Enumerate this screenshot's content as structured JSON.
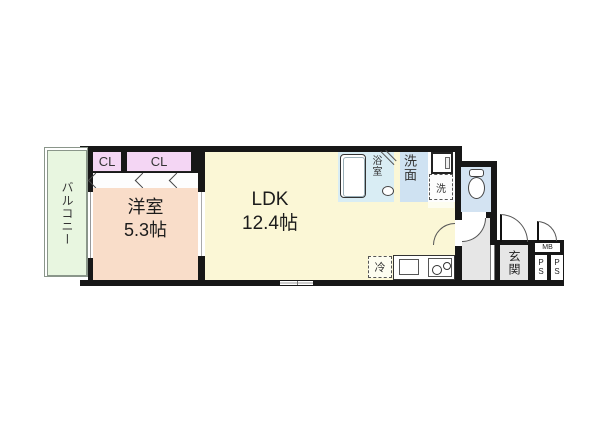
{
  "rooms": {
    "balcony": {
      "label": "バルコニー",
      "color": "#e8f6e0"
    },
    "closet_left": {
      "label": "CL",
      "color": "#f4d6f4"
    },
    "closet_right": {
      "label": "CL",
      "color": "#f4d6f4"
    },
    "bedroom": {
      "label": "洋室",
      "area": "5.3帖",
      "color": "#f9ddc9"
    },
    "ldk": {
      "label": "LDK",
      "area": "12.4帖",
      "color": "#fbf7d6"
    },
    "bath": {
      "label": "浴室",
      "color": "#d9edf4"
    },
    "washroom": {
      "label": "洗面",
      "color": "#cfe2f2"
    },
    "toilet": {
      "color": "#d3e3f2"
    },
    "hallway": {
      "color": "#e6e6e6"
    },
    "entrance": {
      "label": "玄関",
      "color": "#e6e6e6"
    }
  },
  "fixtures": {
    "washer": {
      "label": "洗"
    },
    "fridge": {
      "label": "冷"
    },
    "meter_box": {
      "label": "MB"
    },
    "pipe_space_1": {
      "letters": [
        "P",
        "S"
      ]
    },
    "pipe_space_2": {
      "letters": [
        "P",
        "S"
      ]
    }
  },
  "colors": {
    "wall": "#171717",
    "background": "#ffffff"
  }
}
